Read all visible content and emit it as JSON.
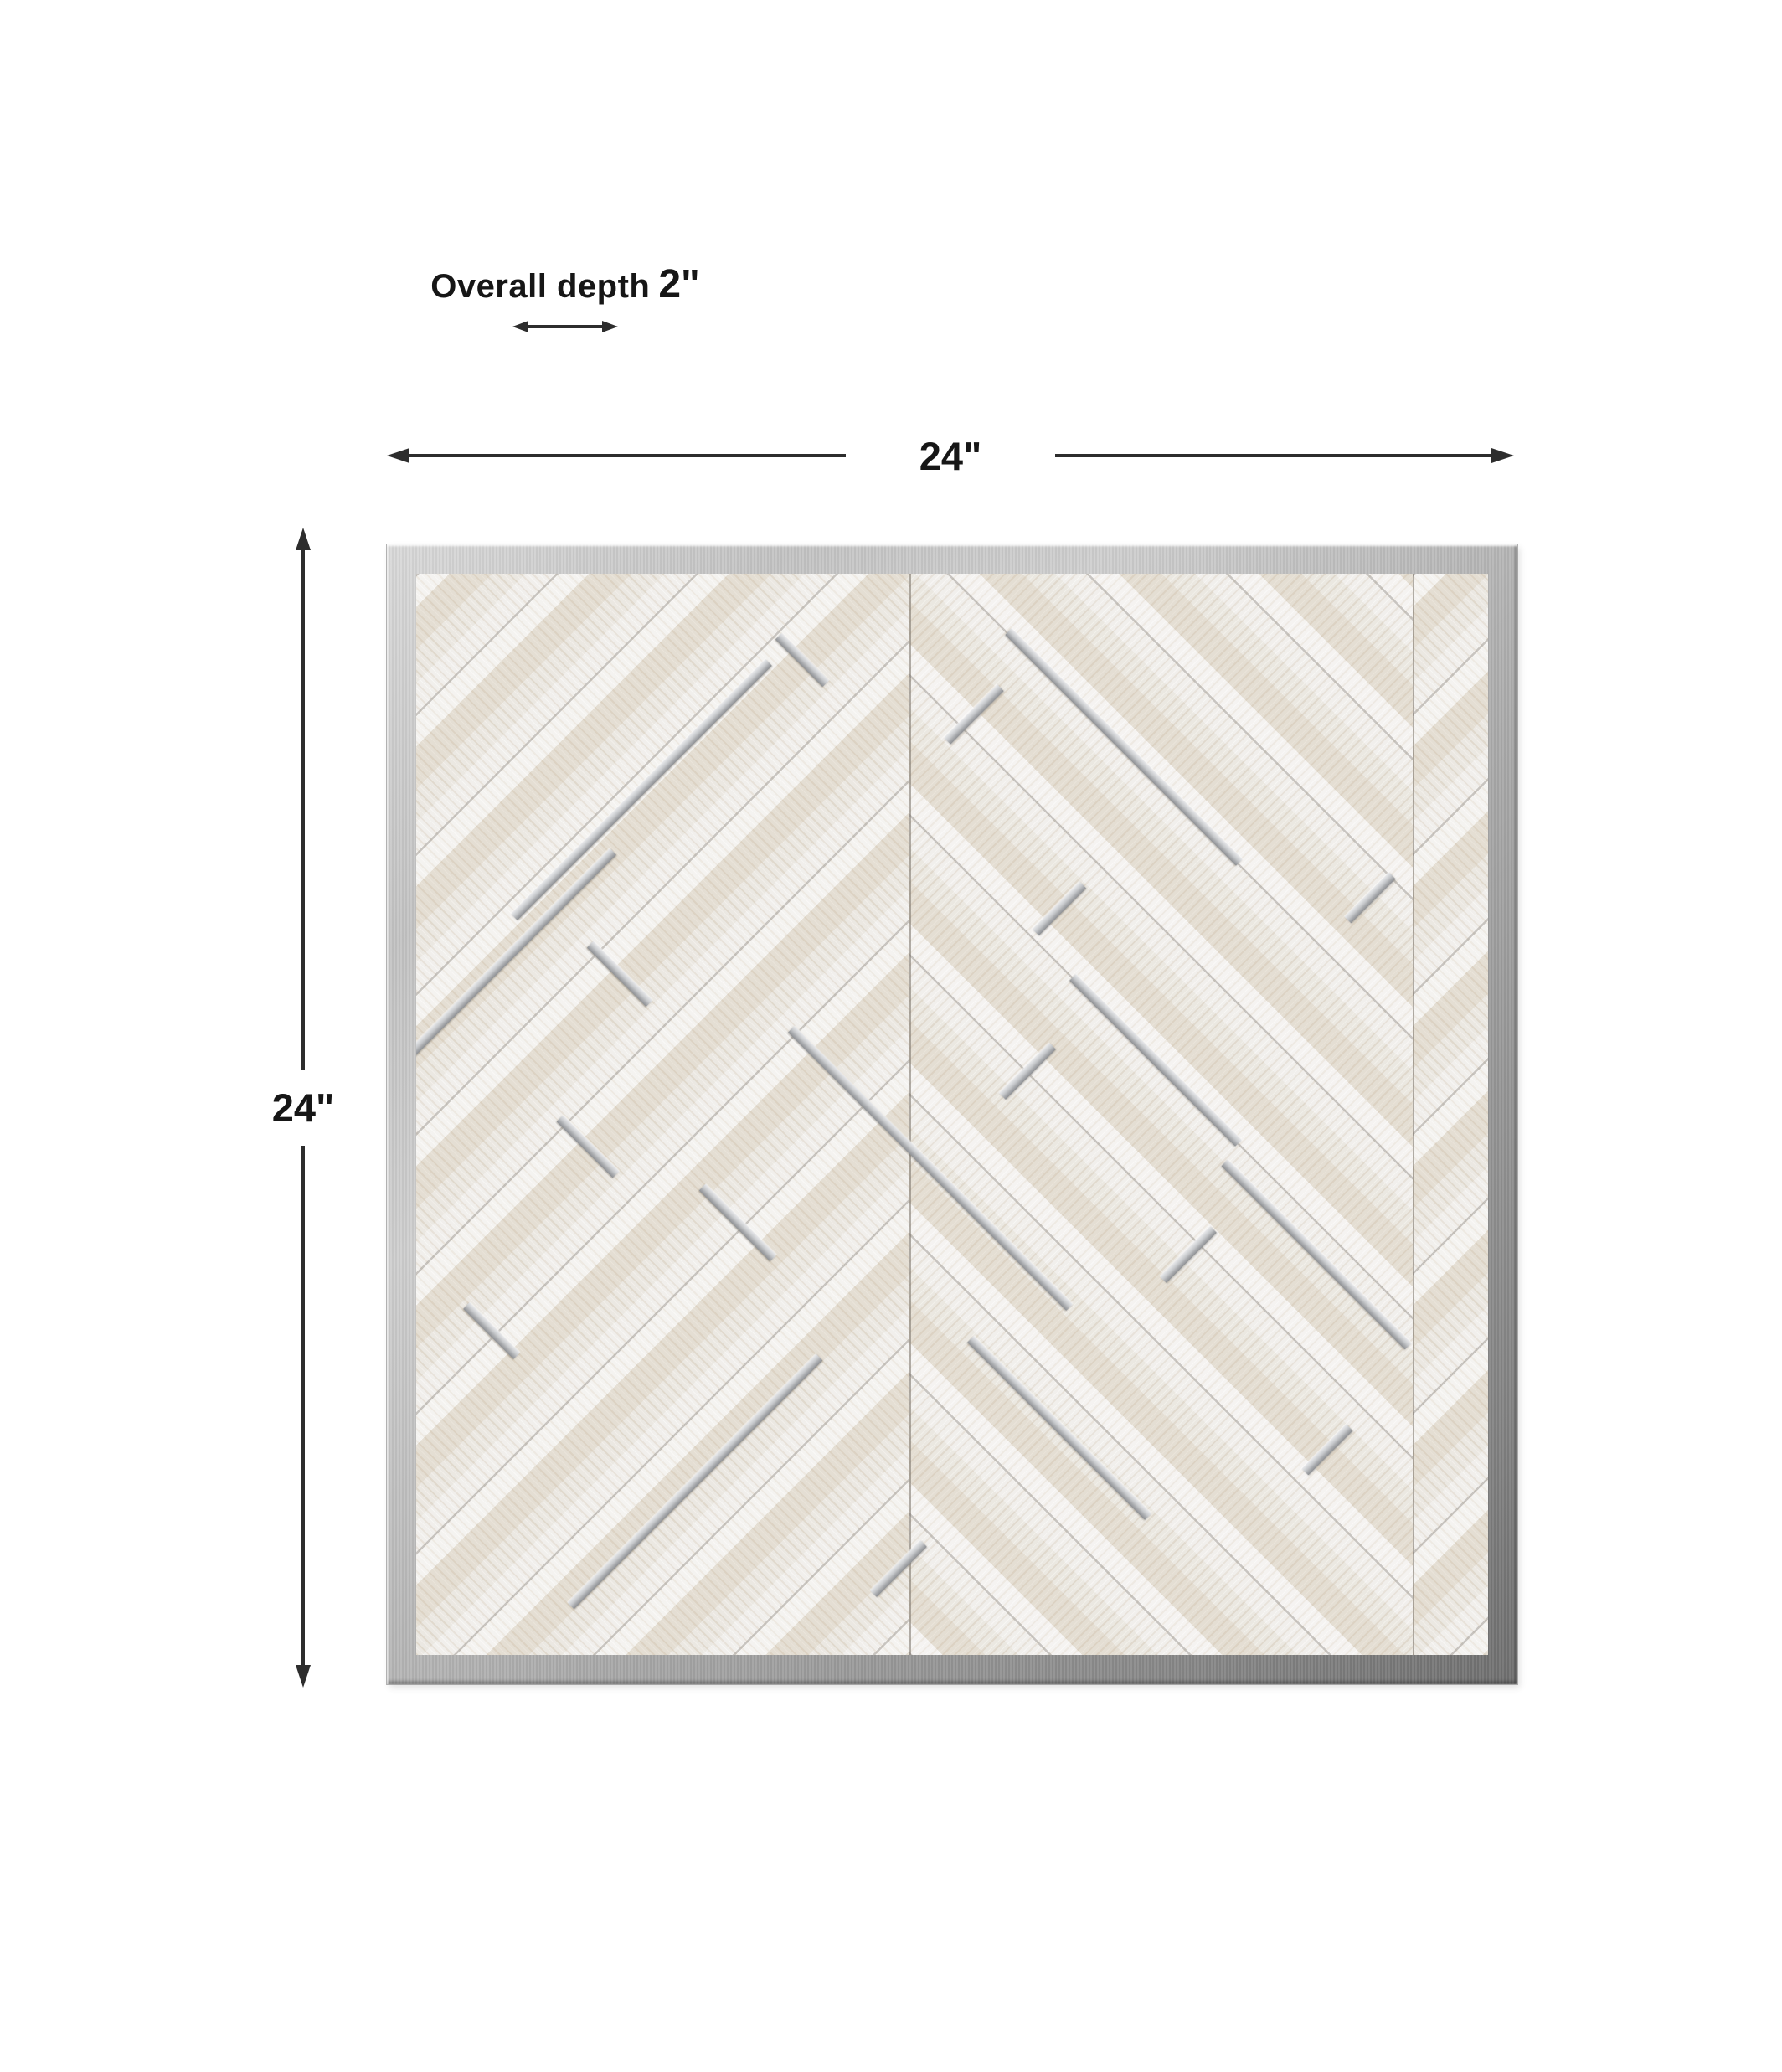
{
  "annotations": {
    "depth": {
      "label": "Overall depth",
      "value": "2\""
    },
    "width": {
      "value": "24\""
    },
    "height": {
      "value": "24\""
    }
  },
  "icons": {
    "depth_arrow": "↔",
    "width_arrow_left": "◄",
    "width_arrow_right": "►",
    "height_arrow_up": "▲",
    "height_arrow_down": "▼"
  },
  "colors": {
    "background": "#ffffff",
    "dimension": "#2d2d2d",
    "ink": "#161616",
    "frame_silver_light": "#d6d6d6",
    "frame_silver_dark": "#6f6f6f",
    "wood_white": "#eae7e2",
    "wood_beige": "#d8c7ac",
    "inlay_silver": "#bfc1c4"
  }
}
